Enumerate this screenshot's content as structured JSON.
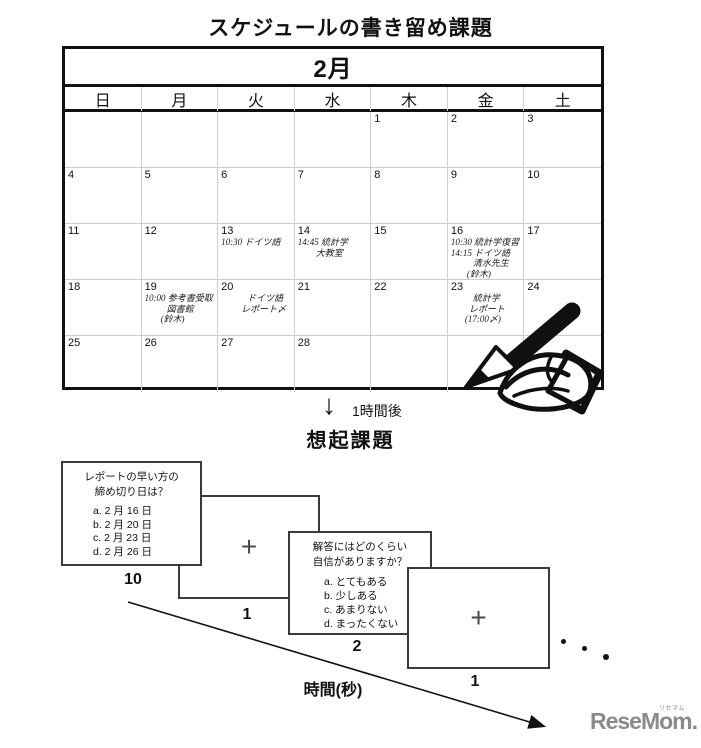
{
  "page": {
    "title": "スケジュールの書き留め課題",
    "recall_title": "想起課題",
    "interval": {
      "arrow_icon": "↓",
      "label": "1時間後"
    },
    "time_axis_label": "時間(秒)",
    "logo": {
      "text": "ReseMom.",
      "ruby": "リセマム"
    }
  },
  "calendar": {
    "month_label": "2月",
    "weekdays": [
      "日",
      "月",
      "火",
      "水",
      "木",
      "金",
      "土"
    ],
    "days": [
      [
        "",
        "",
        "",
        "",
        "1",
        "2",
        "3"
      ],
      [
        "4",
        "5",
        "6",
        "7",
        "8",
        "9",
        "10"
      ],
      [
        "11",
        "12",
        "13",
        "14",
        "15",
        "16",
        "17"
      ],
      [
        "18",
        "19",
        "20",
        "21",
        "22",
        "23",
        "24"
      ],
      [
        "25",
        "26",
        "27",
        "28",
        "",
        "",
        ""
      ]
    ],
    "entries": {
      "d13": [
        "10:30 ドイツ語"
      ],
      "d14": [
        "14:45 統計学",
        "大教室"
      ],
      "d16": [
        "10:30 統計学復習",
        "14:15 ドイツ語",
        "清水先生",
        "(鈴木)"
      ],
      "d19": [
        "10:00 参考書受取",
        "図書館",
        "(鈴木)"
      ],
      "d20": [
        "ドイツ語",
        "レポート〆"
      ],
      "d23": [
        "統計学",
        "レポート",
        "(17:00〆)"
      ]
    }
  },
  "cards": [
    {
      "question_lines": [
        "レポートの早い方の",
        "締め切り日は？"
      ],
      "options": [
        "a. 2 月 16 日",
        "b. 2 月 20 日",
        "c. 2 月 23 日",
        "d. 2 月 26 日"
      ],
      "duration": "10"
    },
    {
      "symbol": "+",
      "duration": "1"
    },
    {
      "question_lines": [
        "解答にはどのくらい",
        "自信がありますか？"
      ],
      "options": [
        "a. とてもある",
        "b. 少しある",
        "c. あまりない",
        "d. まったくない"
      ],
      "duration": "2"
    },
    {
      "symbol": "+",
      "duration": "1"
    }
  ]
}
